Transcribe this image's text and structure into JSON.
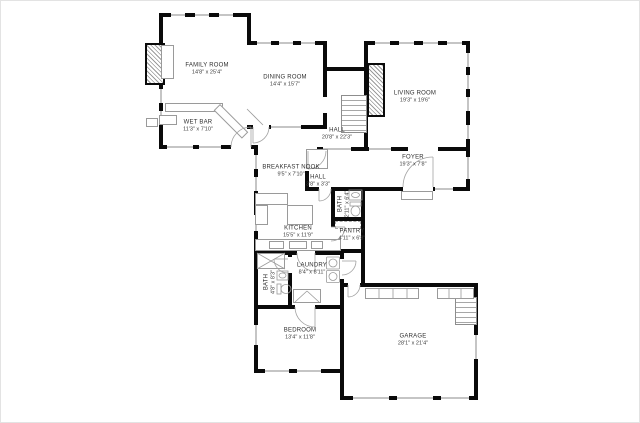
{
  "plan": {
    "background_color": "#ffffff",
    "wall_color": "#0a0a0a",
    "fixture_color": "#9a9a9a",
    "label_color": "#2f2f2f",
    "rooms": [
      {
        "id": "family-room",
        "name": "FAMILY ROOM",
        "dims": "14'8\" x 25'4\""
      },
      {
        "id": "dining-room",
        "name": "DINING ROOM",
        "dims": "14'4\" x 15'7\""
      },
      {
        "id": "living-room",
        "name": "LIVING ROOM",
        "dims": "19'3\" x 19'6\""
      },
      {
        "id": "wet-bar",
        "name": "WET BAR",
        "dims": "11'3\" x 7'10\""
      },
      {
        "id": "hall",
        "name": "HALL",
        "dims": "20'8\" x 22'3\""
      },
      {
        "id": "foyer",
        "name": "FOYER",
        "dims": "19'3\" x 7'8\""
      },
      {
        "id": "breakfast-nook",
        "name": "BREAKFAST NOOK",
        "dims": "9'5\" x 7'10\""
      },
      {
        "id": "hall-small",
        "name": "HALL",
        "dims": "3'8\" x 3'3\""
      },
      {
        "id": "bath-upper",
        "name": "BATH",
        "dims": "2'11\" x 6'4\""
      },
      {
        "id": "kitchen",
        "name": "KITCHEN",
        "dims": "15'5\" x 11'9\""
      },
      {
        "id": "pantry",
        "name": "PANTRY",
        "dims": "4'11\" x 6'8\""
      },
      {
        "id": "laundry",
        "name": "LAUNDRY",
        "dims": "8'4\" x 8'11\""
      },
      {
        "id": "bath-lower",
        "name": "BATH",
        "dims": "4'8\" x 8'3\""
      },
      {
        "id": "bedroom",
        "name": "BEDROOM",
        "dims": "13'4\" x 11'8\""
      },
      {
        "id": "garage",
        "name": "GARAGE",
        "dims": "28'1\" x 21'4\""
      }
    ]
  }
}
